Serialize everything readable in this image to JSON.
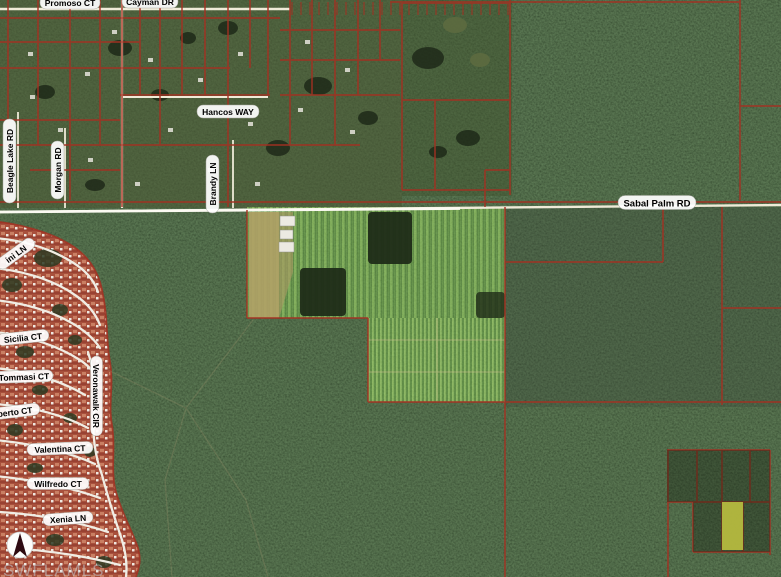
{
  "map": {
    "description": "MLS aerial parcel map",
    "labels": {
      "promoso_ct": "Promoso CT",
      "cayman_dr": "Cayman DR",
      "hancos_way": "Hancos WAY",
      "beagle_lake_rd": "Beagle Lake RD",
      "morgan_rd": "Morgan RD",
      "brandy_ln": "Brandy LN",
      "sabal_palm_rd": "Sabal Palm RD",
      "ini_ln": "ini LN",
      "sicilia_ct": "Sicilia CT",
      "tommasi_ct": "Tommasi CT",
      "berto_ct": "berto CT",
      "valentina_ct": "Valentina CT",
      "wilfredo_ct": "Wilfredo CT",
      "xenia_ln": "Xenia LN",
      "veronawalk_cir": "Veronawalk CIR"
    },
    "watermark": "SWFLAMLS",
    "compass": "north-arrow",
    "colors": {
      "parcel_line": "#A33122",
      "road": "#EFEBD8",
      "road_bright": "#FBFAF2",
      "label_bg": "#FFFFFF",
      "label_text": "#000000",
      "highlight_parcel": "#B5B93F",
      "forest_dark": "#27331F",
      "residential_green": "#4A5733",
      "farm_light": "#84B156",
      "farm_dark": "#55813A",
      "development_red": "#A8503C",
      "soil_tan": "#B0A166",
      "watermark_color": "#C3C9CE"
    }
  }
}
